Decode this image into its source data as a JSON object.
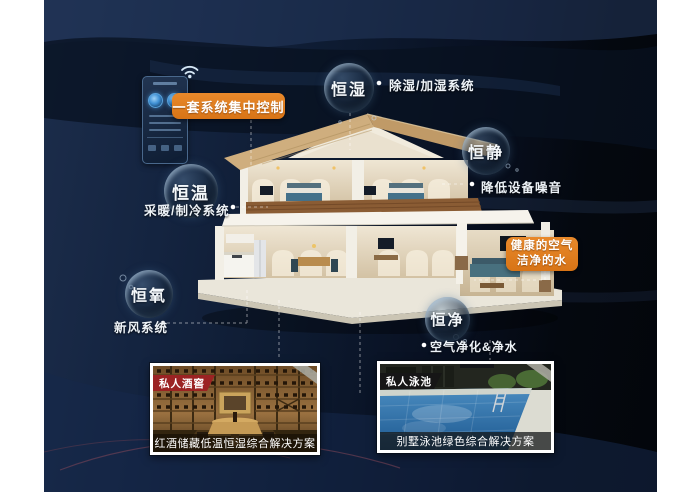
{
  "control": {
    "badge": "一套系统集中控制"
  },
  "health": {
    "line1": "健康的空气",
    "line2": "洁净的水"
  },
  "bubbles": {
    "humidity": {
      "label": "恒湿",
      "note": "除湿/加湿系统"
    },
    "quiet": {
      "label": "恒静",
      "note": "降低设备噪音"
    },
    "temperature": {
      "label": "恒温",
      "note": "采暖/制冷系统"
    },
    "oxygen": {
      "label": "恒氧",
      "note": "新风系统"
    },
    "purity": {
      "label": "恒净",
      "note": "空气净化&净水"
    }
  },
  "photos": {
    "wine": {
      "badge": "私人酒窖",
      "caption": "红酒储藏低温恒湿综合解决方案"
    },
    "pool": {
      "badge": "私人泳池",
      "caption": "别墅泳池绿色综合解决方案"
    }
  },
  "colors": {
    "accent_orange": "#DE7D1C",
    "badge_red": "#9B2323",
    "badge_black": "#161616",
    "background_navy": "#0E1B2E"
  }
}
